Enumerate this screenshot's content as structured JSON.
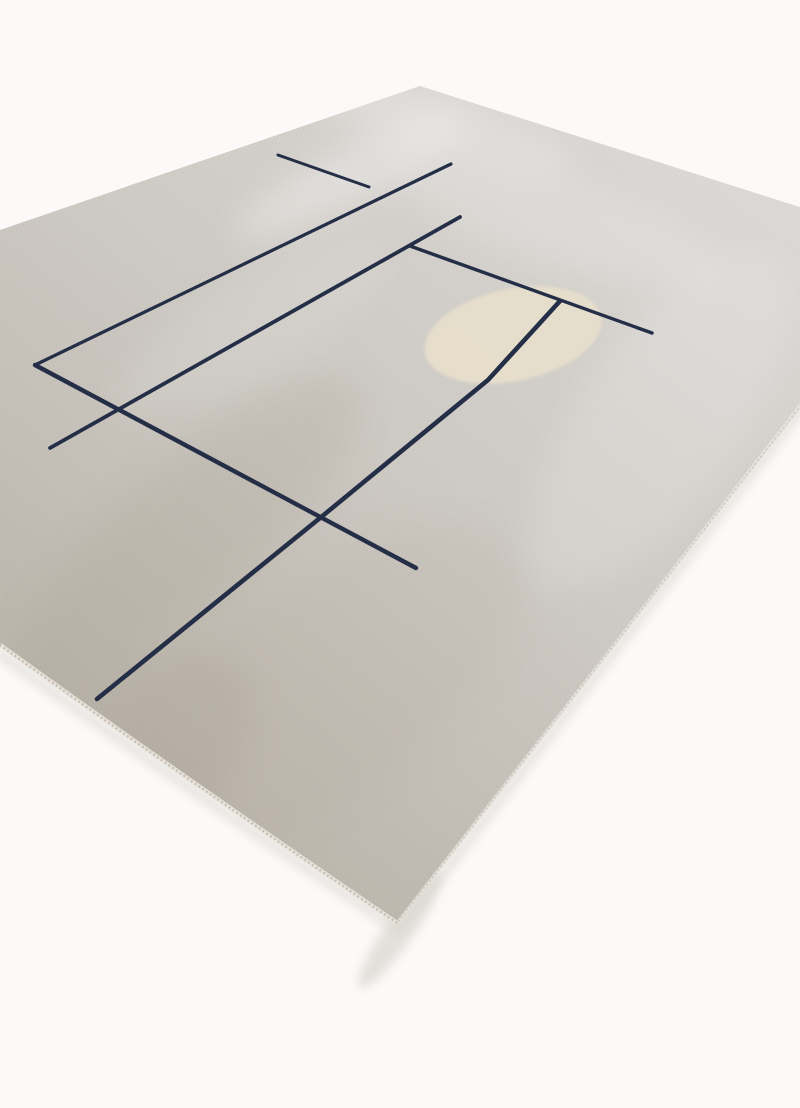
{
  "canvas": {
    "width": 800,
    "height": 1108,
    "background": "#fbfaf8"
  },
  "rug": {
    "outline_path": "M 420,86 L 922,246 L 397,923 Q 180,775 0,645 L -432,378 Z",
    "base_gradient": {
      "x1": 680,
      "y1": 100,
      "x2": 40,
      "y2": 900,
      "stops": [
        {
          "offset": 0,
          "color": "#dcdad7"
        },
        {
          "offset": 0.45,
          "color": "#cdc9c3"
        },
        {
          "offset": 1,
          "color": "#b4ada2"
        }
      ]
    },
    "shadow": {
      "path": "M 845,352 L 399,930 Q 180,784 0,654",
      "color": "#e2dfda",
      "width": 10,
      "opacity": 0.85,
      "corner": {
        "cx": 400,
        "cy": 930,
        "rx": 70,
        "ry": 14,
        "rot": -55,
        "color": "#d9d5cf",
        "opacity": 0.7
      }
    },
    "edges": {
      "bottom_left_path": "M 397,923 Q 180,775 0,645",
      "bottom_right_path": "M 838,358 L 397,923",
      "binding_color": "#e8e4dc",
      "binding_width": 4.5,
      "stitch_color": "#bab2a5",
      "stitch_width": 2.2,
      "stitch_dash": "1.8 2.8",
      "right_binding_color": "#e3dfd8",
      "right_binding_width": 3
    }
  },
  "sheen_patches": [
    {
      "cx": 350,
      "cy": 175,
      "rx": 130,
      "ry": 28,
      "rot": -27,
      "color": "#ffffff",
      "opacity": 0.3
    },
    {
      "cx": 430,
      "cy": 120,
      "rx": 150,
      "ry": 30,
      "rot": 18,
      "color": "#ffffff",
      "opacity": 0.22
    },
    {
      "cx": 560,
      "cy": 220,
      "rx": 170,
      "ry": 45,
      "rot": 17,
      "color": "#ffffff",
      "opacity": 0.16
    },
    {
      "cx": 660,
      "cy": 420,
      "rx": 200,
      "ry": 80,
      "rot": -55,
      "color": "#ffffff",
      "opacity": 0.15
    },
    {
      "cx": 185,
      "cy": 540,
      "rx": 230,
      "ry": 70,
      "rot": -42,
      "color": "#948876",
      "opacity": 0.13
    },
    {
      "cx": 90,
      "cy": 800,
      "rx": 200,
      "ry": 90,
      "rot": -40,
      "color": "#9a8f80",
      "opacity": 0.17
    },
    {
      "cx": 300,
      "cy": 700,
      "rx": 260,
      "ry": 110,
      "rot": -35,
      "color": "#aca294",
      "opacity": 0.11
    },
    {
      "cx": 250,
      "cy": 330,
      "rx": 160,
      "ry": 45,
      "rot": -30,
      "color": "#ffffff",
      "opacity": 0.1
    }
  ],
  "weave_texture": {
    "spacing": 3.5,
    "angle_v": -35,
    "angle_u": 20,
    "light_color": "rgba(255,255,255,0.07)",
    "dark_color": "rgba(110,100,88,0.06)"
  },
  "accent_circle": {
    "cx": 513,
    "cy": 335,
    "rx": 90,
    "ry": 46,
    "rot": -12,
    "color": "#e7dfcc",
    "opacity": 0.95,
    "blur": 1.6
  },
  "line_pattern": {
    "color": "#242e46",
    "lines": [
      {
        "name": "vertical-long-1",
        "path": "M 35,365 L 451,164",
        "width": 3.2
      },
      {
        "name": "vertical-long-2",
        "path": "M 50,448 L 460,217",
        "width": 3.8
      },
      {
        "name": "vertical-long-3",
        "path": "M 97,699 L 320,518 L 488,380 L 560,301",
        "width": 4.6
      },
      {
        "name": "horizontal-short",
        "path": "M 278,155 L 369,187",
        "width": 3.0
      },
      {
        "name": "horizontal-long",
        "path": "M 35,365 L 416,568",
        "width": 4.4
      },
      {
        "name": "horizontal-mid",
        "path": "M 410,246 L 652,333",
        "width": 3.4
      }
    ]
  }
}
